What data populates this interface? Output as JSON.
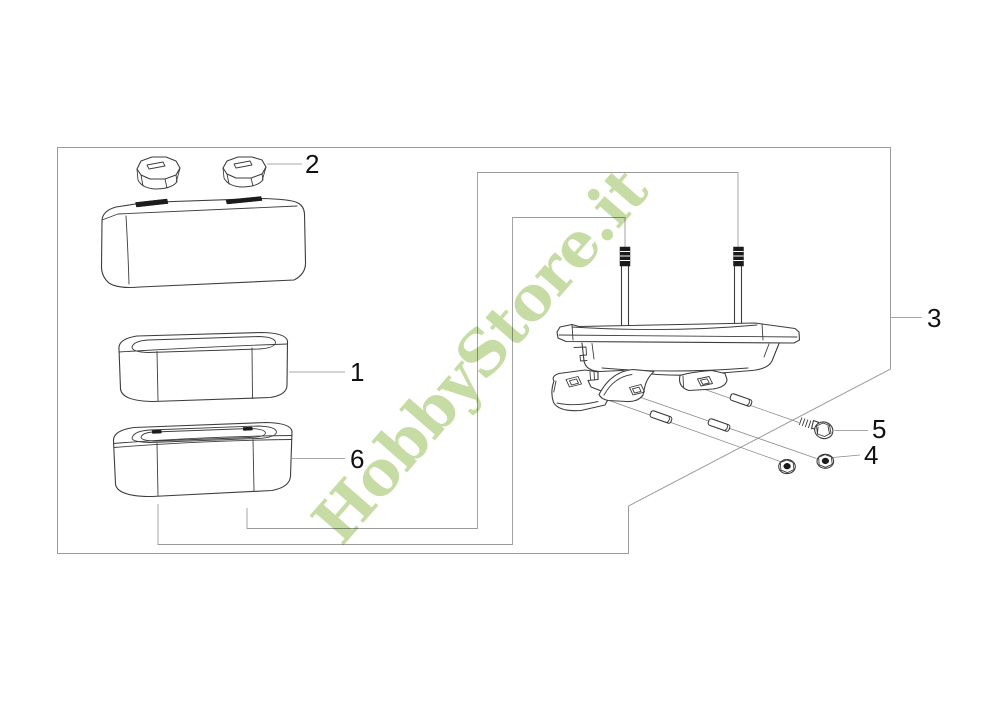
{
  "watermark": {
    "text": "HobbyStore.it",
    "color": "#b9d48f"
  },
  "diagram": {
    "labels": [
      {
        "text": "2"
      },
      {
        "text": "1"
      },
      {
        "text": "6"
      },
      {
        "text": "3"
      },
      {
        "text": "5"
      },
      {
        "text": "4"
      }
    ],
    "colors": {
      "line": "#3d3d3d",
      "border": "#9b9b9b",
      "leader": "#8a8a8a",
      "background": "#ffffff"
    }
  }
}
